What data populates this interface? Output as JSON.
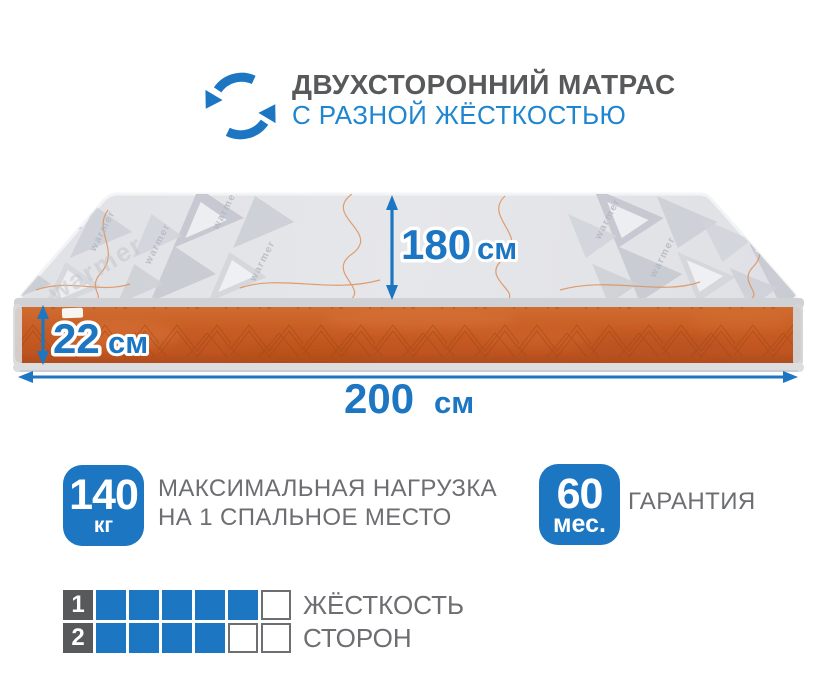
{
  "header": {
    "icon": "rotate-arrows-icon",
    "title": "ДВУХСТОРОННИЙ МАТРАС",
    "subtitle": "С РАЗНОЙ ЖЁСТКОСТЬЮ"
  },
  "mattress": {
    "fabric_watermark": "warmer",
    "dimensions": {
      "length": {
        "value": "180",
        "unit": "см"
      },
      "height": {
        "value": "22",
        "unit": "см"
      },
      "width": {
        "value": "200",
        "unit": "см"
      }
    }
  },
  "features": [
    {
      "badge_value": "140",
      "badge_unit": "кг",
      "label_line1": "МАКСИМАЛЬНАЯ НАГРУЗКА",
      "label_line2": "НА 1 СПАЛЬНОЕ МЕСТО"
    },
    {
      "badge_value": "60",
      "badge_unit": "мес.",
      "label_line1": "ГАРАНТИЯ"
    }
  ],
  "ratings": {
    "label_line1": "ЖЁСТКОСТЬ",
    "label_line2": "СТОРОН",
    "rows": [
      {
        "number": "1",
        "filled": 5,
        "total": 6
      },
      {
        "number": "2",
        "filled": 4,
        "total": 6
      }
    ]
  },
  "colors": {
    "accent_blue": "#1c76c2",
    "subtitle_blue": "#1e86d0",
    "title_gray": "#58595b",
    "text_gray": "#6d6e71",
    "mattress_orange": "#c85d24",
    "fabric_gray": "#e3e4e8"
  }
}
